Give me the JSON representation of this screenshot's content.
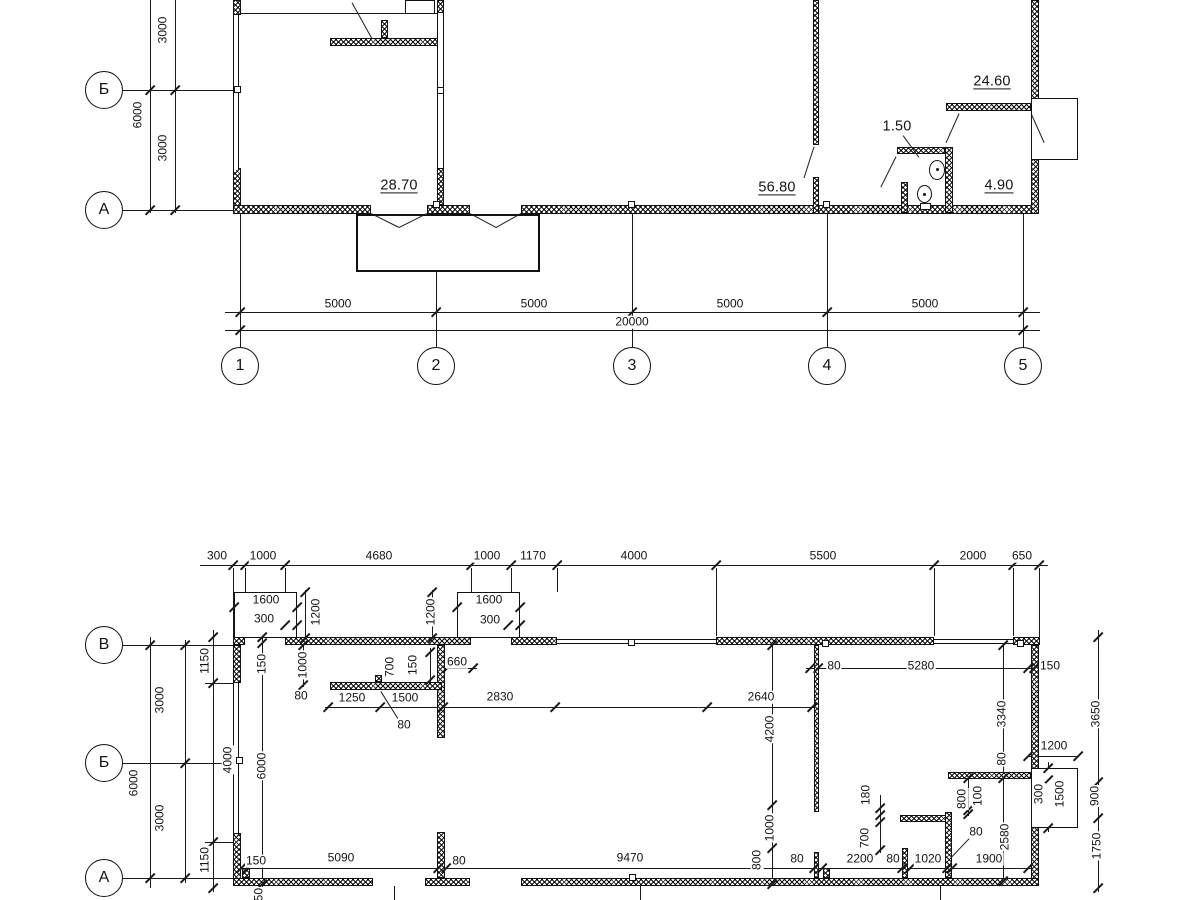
{
  "colors": {
    "line": "#1a1a1a",
    "background": "#ffffff"
  },
  "top_plan": {
    "row_axes": [
      {
        "label": "Б",
        "x": 104,
        "y": 90
      },
      {
        "label": "А",
        "x": 104,
        "y": 210
      }
    ],
    "col_axes": [
      {
        "label": "1",
        "x": 240,
        "y": 366
      },
      {
        "label": "2",
        "x": 436,
        "y": 366
      },
      {
        "label": "3",
        "x": 632,
        "y": 366
      },
      {
        "label": "4",
        "x": 827,
        "y": 366
      },
      {
        "label": "5",
        "x": 1023,
        "y": 366
      }
    ],
    "room_areas": [
      {
        "t": "28.70",
        "x": 399,
        "y": 186,
        "u": true
      },
      {
        "t": "56.80",
        "x": 777,
        "y": 188,
        "u": true
      },
      {
        "t": "1.50",
        "x": 897,
        "y": 127,
        "u": false
      },
      {
        "t": "24.60",
        "x": 992,
        "y": 82,
        "u": true
      },
      {
        "t": "4.90",
        "x": 999,
        "y": 186,
        "u": true
      }
    ],
    "dim_labels": [
      {
        "t": "3000",
        "x": 163,
        "y": 30,
        "r": 1
      },
      {
        "t": "6000",
        "x": 138,
        "y": 115,
        "r": 1
      },
      {
        "t": "3000",
        "x": 163,
        "y": 148,
        "r": 1
      },
      {
        "t": "5000",
        "x": 338,
        "y": 304
      },
      {
        "t": "5000",
        "x": 534,
        "y": 304
      },
      {
        "t": "5000",
        "x": 730,
        "y": 304
      },
      {
        "t": "5000",
        "x": 925,
        "y": 304
      },
      {
        "t": "20000",
        "x": 632,
        "y": 322
      }
    ]
  },
  "bottom_plan": {
    "row_axes": [
      {
        "label": "В",
        "x": 104,
        "y": 645
      },
      {
        "label": "Б",
        "x": 104,
        "y": 763
      },
      {
        "label": "А",
        "x": 104,
        "y": 878
      }
    ],
    "dim_labels": [
      {
        "t": "300",
        "x": 217,
        "y": 556
      },
      {
        "t": "1000",
        "x": 263,
        "y": 556
      },
      {
        "t": "4680",
        "x": 379,
        "y": 556
      },
      {
        "t": "1000",
        "x": 487,
        "y": 556
      },
      {
        "t": "1170",
        "x": 533,
        "y": 556
      },
      {
        "t": "4000",
        "x": 634,
        "y": 556
      },
      {
        "t": "5500",
        "x": 823,
        "y": 556
      },
      {
        "t": "2000",
        "x": 973,
        "y": 556
      },
      {
        "t": "650",
        "x": 1022,
        "y": 556
      },
      {
        "t": "1600",
        "x": 266,
        "y": 600
      },
      {
        "t": "300",
        "x": 264,
        "y": 619
      },
      {
        "t": "1200",
        "x": 316,
        "y": 612,
        "r": 1
      },
      {
        "t": "1600",
        "x": 489,
        "y": 600
      },
      {
        "t": "300",
        "x": 490,
        "y": 620
      },
      {
        "t": "1200",
        "x": 431,
        "y": 612,
        "r": 1
      },
      {
        "t": "1150",
        "x": 205,
        "y": 661,
        "r": 1
      },
      {
        "t": "3000",
        "x": 160,
        "y": 700,
        "r": 1
      },
      {
        "t": "4000",
        "x": 228,
        "y": 760,
        "r": 1
      },
      {
        "t": "6000",
        "x": 134,
        "y": 783,
        "r": 1
      },
      {
        "t": "3000",
        "x": 160,
        "y": 818,
        "r": 1
      },
      {
        "t": "1150",
        "x": 205,
        "y": 860,
        "r": 1
      },
      {
        "t": "150",
        "x": 262,
        "y": 664,
        "r": 1
      },
      {
        "t": "6000",
        "x": 262,
        "y": 766,
        "r": 1
      },
      {
        "t": "1000",
        "x": 303,
        "y": 665,
        "r": 1
      },
      {
        "t": "80",
        "x": 301,
        "y": 696
      },
      {
        "t": "700",
        "x": 390,
        "y": 667,
        "r": 1
      },
      {
        "t": "150",
        "x": 413,
        "y": 665,
        "r": 1
      },
      {
        "t": "660",
        "x": 457,
        "y": 662
      },
      {
        "t": "1250",
        "x": 352,
        "y": 698
      },
      {
        "t": "1500",
        "x": 405,
        "y": 698
      },
      {
        "t": "80",
        "x": 404,
        "y": 725
      },
      {
        "t": "2830",
        "x": 500,
        "y": 697
      },
      {
        "t": "2640",
        "x": 761,
        "y": 697
      },
      {
        "t": "4200",
        "x": 770,
        "y": 729,
        "r": 1
      },
      {
        "t": "1000",
        "x": 770,
        "y": 828,
        "r": 1
      },
      {
        "t": "800",
        "x": 757,
        "y": 860,
        "r": 1
      },
      {
        "t": "80",
        "x": 834,
        "y": 666
      },
      {
        "t": "5280",
        "x": 921,
        "y": 666
      },
      {
        "t": "150",
        "x": 1050,
        "y": 666
      },
      {
        "t": "3340",
        "x": 1002,
        "y": 714,
        "r": 1
      },
      {
        "t": "3650",
        "x": 1096,
        "y": 714,
        "r": 1
      },
      {
        "t": "1200",
        "x": 1054,
        "y": 746
      },
      {
        "t": "80",
        "x": 1002,
        "y": 759,
        "r": 1
      },
      {
        "t": "180",
        "x": 866,
        "y": 795,
        "r": 1
      },
      {
        "t": "700",
        "x": 865,
        "y": 838,
        "r": 1
      },
      {
        "t": "800",
        "x": 962,
        "y": 799,
        "r": 1
      },
      {
        "t": "100",
        "x": 978,
        "y": 796,
        "r": 1
      },
      {
        "t": "300",
        "x": 1039,
        "y": 794,
        "r": 1
      },
      {
        "t": "1500",
        "x": 1060,
        "y": 794,
        "r": 1
      },
      {
        "t": "900",
        "x": 1095,
        "y": 796,
        "r": 1
      },
      {
        "t": "2580",
        "x": 1005,
        "y": 837,
        "r": 1
      },
      {
        "t": "1750",
        "x": 1097,
        "y": 846,
        "r": 1
      },
      {
        "t": "80",
        "x": 976,
        "y": 832
      },
      {
        "t": "1900",
        "x": 989,
        "y": 859
      },
      {
        "t": "150",
        "x": 256,
        "y": 861
      },
      {
        "t": "5090",
        "x": 341,
        "y": 858
      },
      {
        "t": "80",
        "x": 459,
        "y": 861
      },
      {
        "t": "9470",
        "x": 630,
        "y": 858
      },
      {
        "t": "80",
        "x": 797,
        "y": 859
      },
      {
        "t": "2200",
        "x": 860,
        "y": 859
      },
      {
        "t": "80",
        "x": 893,
        "y": 859
      },
      {
        "t": "1020",
        "x": 928,
        "y": 859
      },
      {
        "t": "150",
        "x": 259,
        "y": 898,
        "r": 1
      }
    ]
  }
}
